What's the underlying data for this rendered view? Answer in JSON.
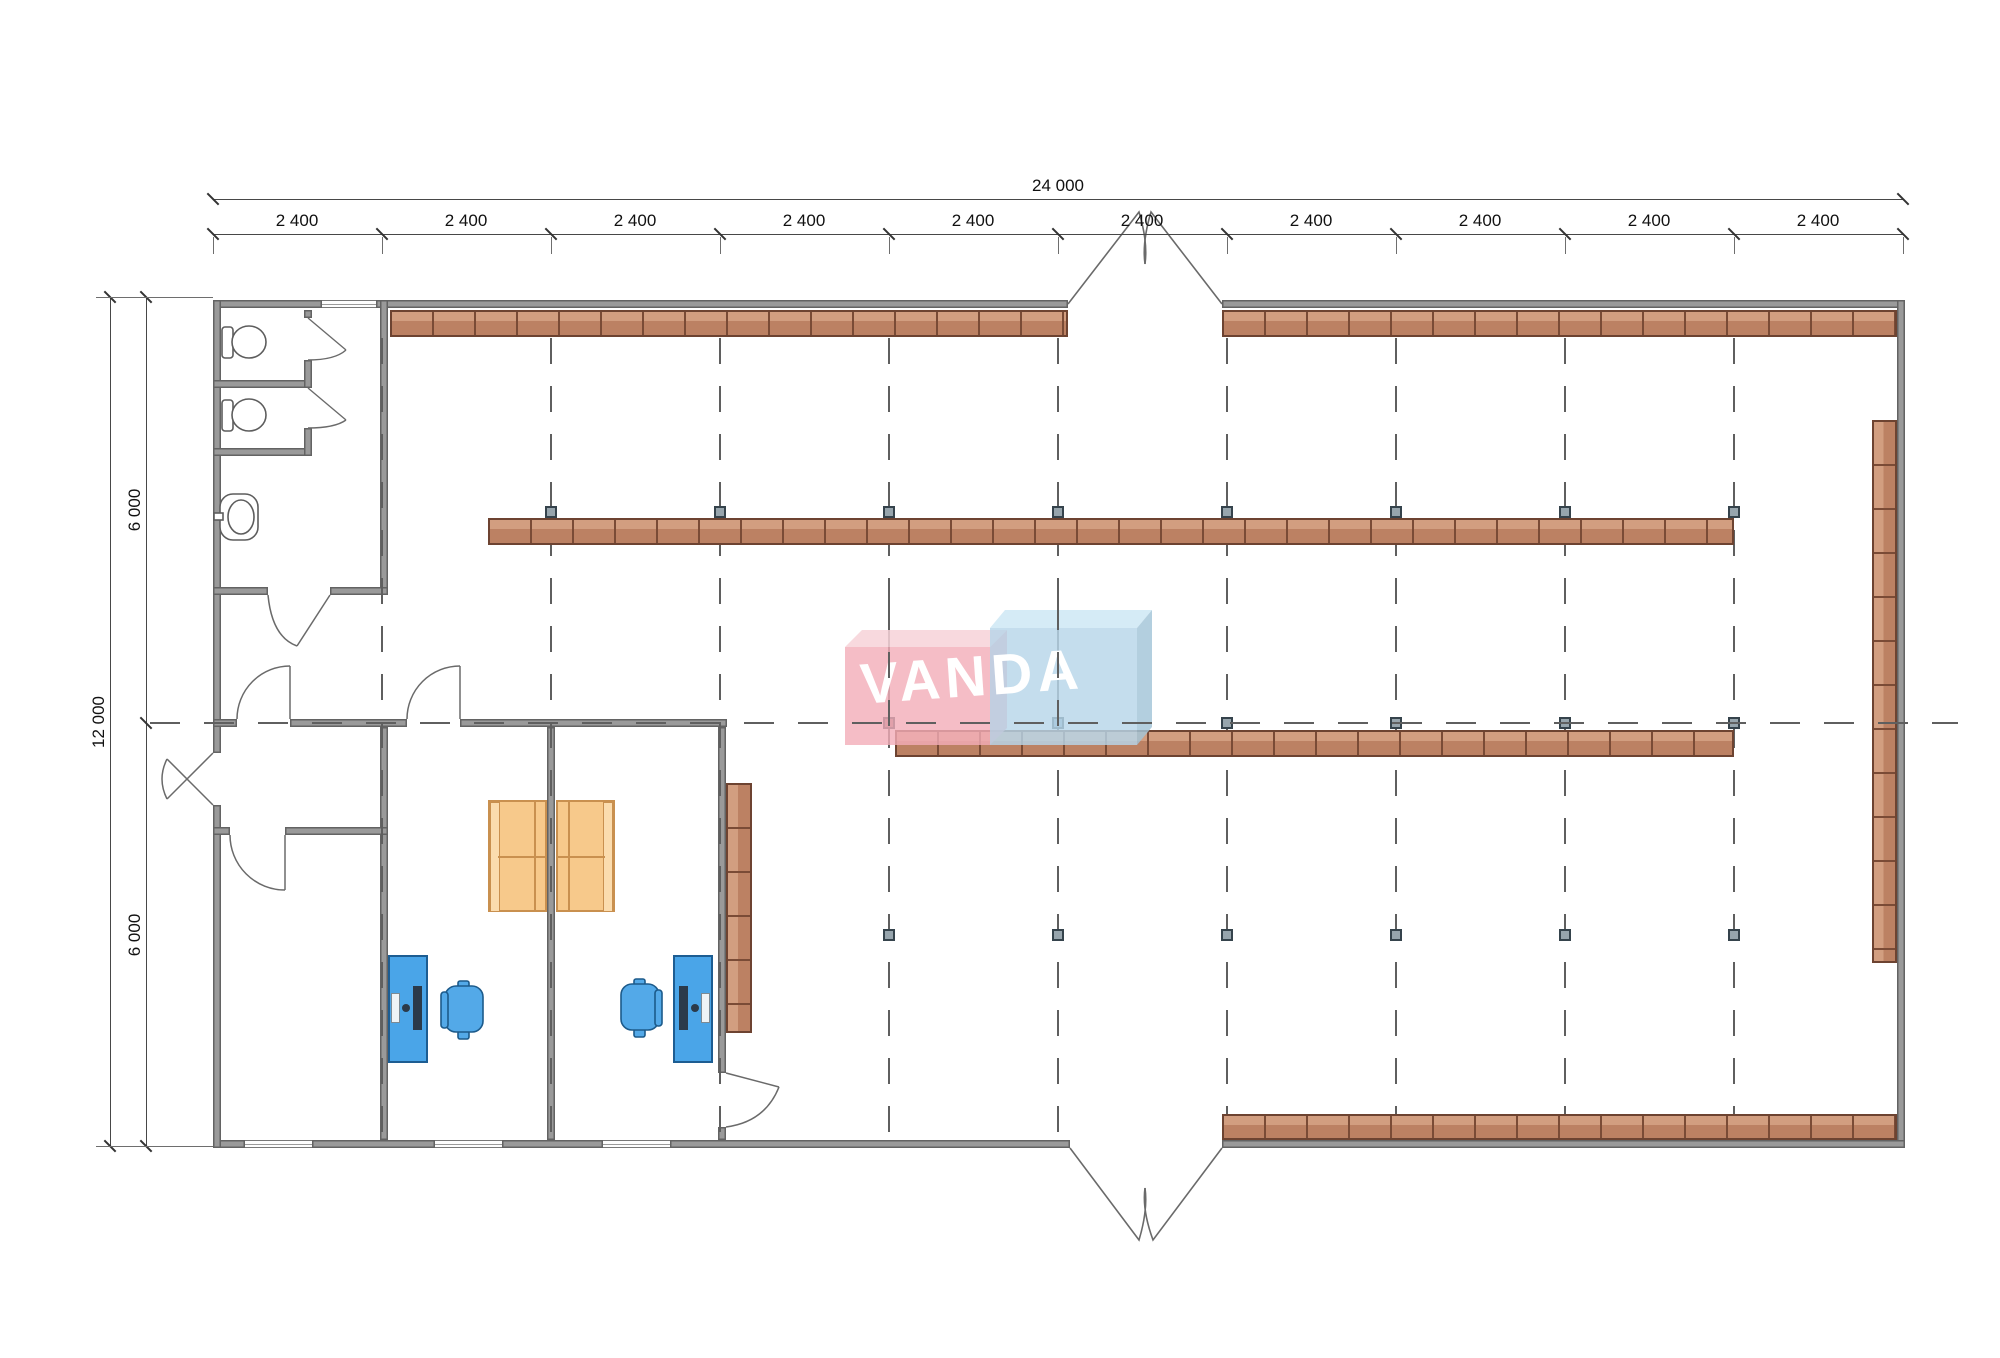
{
  "drawing": {
    "brand": "VANDA",
    "dim_total_width": "24 000",
    "dim_segments": [
      "2 400",
      "2 400",
      "2 400",
      "2 400",
      "2 400",
      "2 400",
      "2 400",
      "2 400",
      "2 400",
      "2 400"
    ],
    "dim_total_height": "12 000",
    "dim_height_upper": "6 000",
    "dim_height_lower": "6 000"
  },
  "colors": {
    "wall": "#9a9a9a",
    "shelving": "#bc8163",
    "shelving_light": "#d29e80",
    "desk_blue": "#4aa5e8",
    "sofa_orange": "#f7c98b",
    "column_marker": "#97a5ad",
    "logo_pink": "#f3acb8",
    "logo_blue": "#b7d6e9",
    "grid_line": "#5f5f5f"
  }
}
